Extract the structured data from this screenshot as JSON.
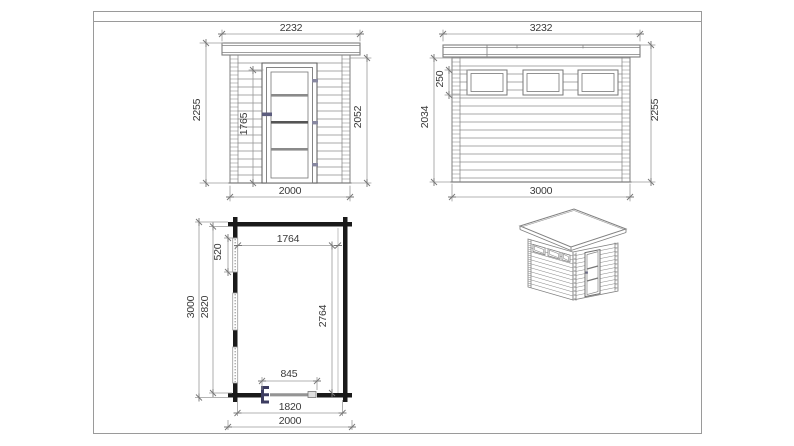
{
  "drawing": {
    "front_elevation": {
      "label": "front-elevation",
      "dims": {
        "roof_width_mm": "2232",
        "overall_height_mm": "2255",
        "door_height_mm": "1765",
        "wall_height_mm": "2052",
        "base_width_mm": "2000"
      }
    },
    "side_elevation": {
      "label": "side-elevation",
      "dims": {
        "roof_length_mm": "3232",
        "window_height_mm": "250",
        "wall_height_mm": "2034",
        "overall_height_mm": "2255",
        "base_length_mm": "3000"
      }
    },
    "floor_plan": {
      "label": "floor-plan",
      "dims": {
        "interior_width_mm": "1764",
        "window_length_mm": "520",
        "outer_depth_mm": "3000",
        "inner_depth_mm": "2820",
        "interior_depth_mm": "2764",
        "door_width_mm": "845",
        "inner_width_mm": "1820",
        "outer_width_mm": "2000"
      }
    },
    "isometric_view": {
      "label": "isometric-view"
    },
    "colors": {
      "line": "#7f7f7f",
      "dim_line": "#9a9a9a",
      "text": "#3a3a3a",
      "plan_wall": "#1a1a1a",
      "hinge_accent": "#3c3c60",
      "frame_border": "#9a9a9a"
    }
  }
}
